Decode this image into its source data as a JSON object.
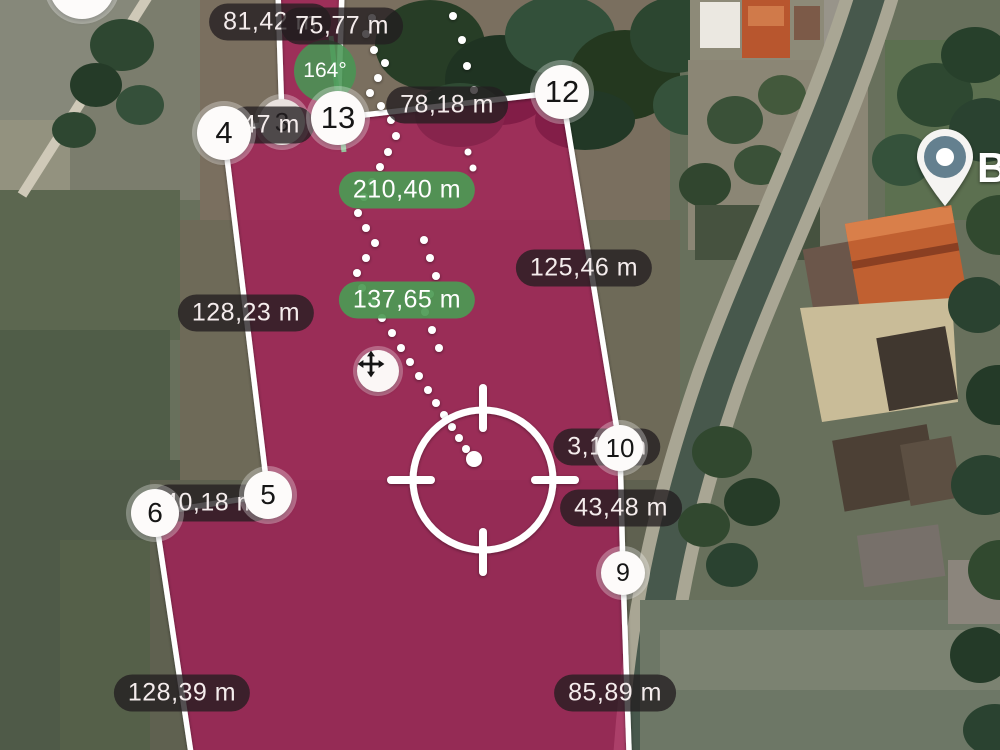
{
  "map": {
    "description": "Satellite field-area measurement view with highlighted parcel",
    "poi_label": "B",
    "compass_angle": "164°",
    "markers": [
      {
        "id": "3",
        "label": "3"
      },
      {
        "id": "4",
        "label": "4"
      },
      {
        "id": "5",
        "label": "5"
      },
      {
        "id": "6",
        "label": "6"
      },
      {
        "id": "9",
        "label": "9"
      },
      {
        "id": "10",
        "label": "10"
      },
      {
        "id": "12",
        "label": "12"
      },
      {
        "id": "13",
        "label": "13"
      }
    ],
    "distance_labels": [
      {
        "text": "81,42 m",
        "style": "dark"
      },
      {
        "text": "75,77 m",
        "style": "dark"
      },
      {
        "text": "78,18 m",
        "style": "dark"
      },
      {
        "text": "47 m",
        "style": "dark"
      },
      {
        "text": "210,40 m",
        "style": "green"
      },
      {
        "text": "137,65 m",
        "style": "green"
      },
      {
        "text": "125,46 m",
        "style": "dark"
      },
      {
        "text": "128,23 m",
        "style": "dark"
      },
      {
        "text": "3,10 m",
        "style": "dark"
      },
      {
        "text": "43,48 m",
        "style": "dark"
      },
      {
        "text": "40,18 m",
        "style": "dark"
      },
      {
        "text": "128,39 m",
        "style": "dark"
      },
      {
        "text": "85,89 m",
        "style": "dark"
      }
    ],
    "colors": {
      "area_fill": "#ad1457",
      "green_label": "#4c9a54",
      "dark_label": "rgba(35,30,32,0.78)",
      "edge_stroke": "#ffffff"
    }
  }
}
